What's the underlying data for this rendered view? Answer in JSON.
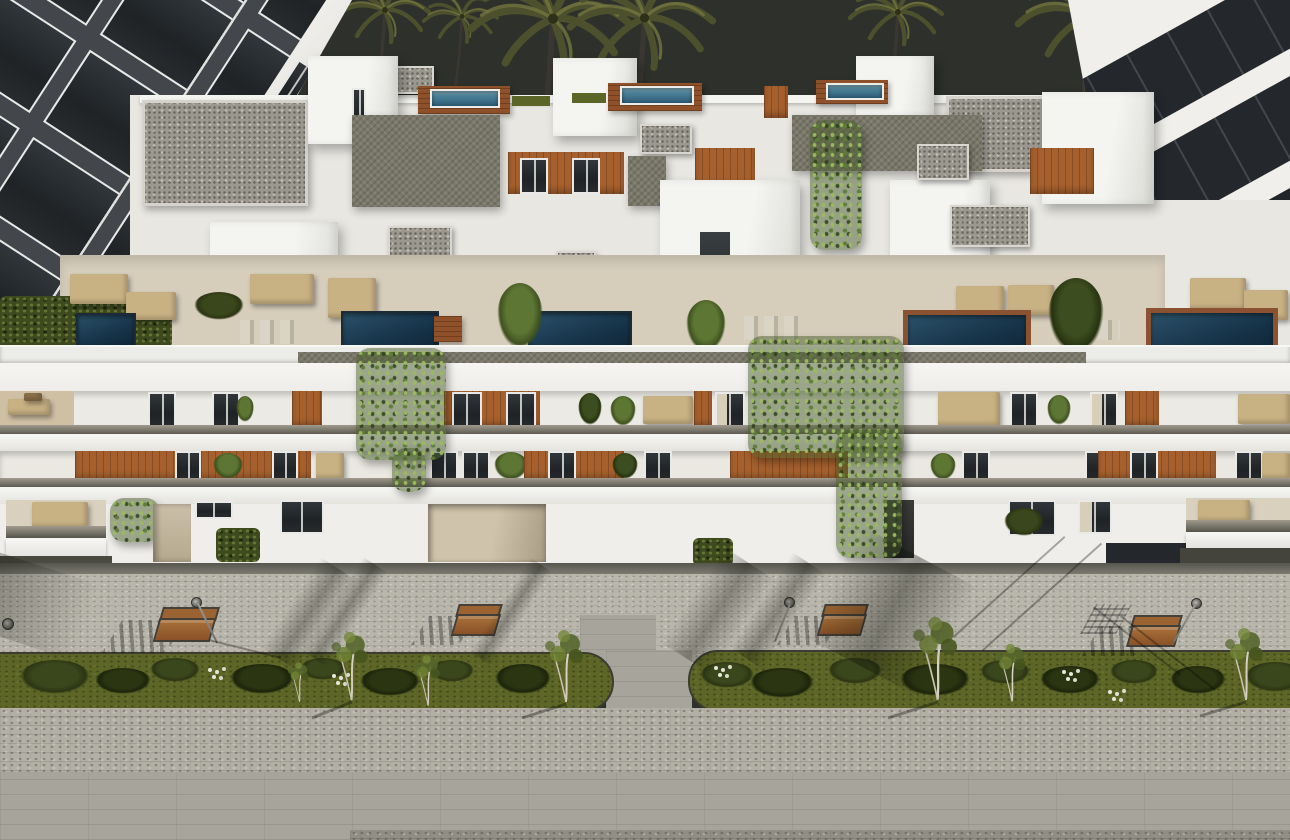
{
  "scene": {
    "title": "Aerial dusk rendering of a modern apartment complex",
    "description": "Photorealistic 3D architectural visualization seen from above at dusk: a long white three-storey apartment building with recessed balconies, timber panels and cascading vines; a rooftop level of private terraces with plunge pools, wooden decks, gravel roofs and outdoor lounge furniture; a dark apartment block on the left and a white building with tinted glass balconies on the right; palm trees against a dark sky; a landscaped boulevard in the foreground with paved sidewalk, two oval planting islands with bushes and young trees, timber benches and street lamps.",
    "setting": "dusk",
    "style": "photorealistic CGI render",
    "view": "high-angle aerial"
  },
  "palette": {
    "sky": "#2d302b",
    "wall_white": "#f0efeb",
    "wall_shade": "#e8e7e2",
    "parapet": "#ecece8",
    "beam_white": "#f3f2ef",
    "left_facade": "#43464a",
    "glass_dark": "#24282c",
    "gravel": "#9b988f",
    "taupe_wall": "#7a7869",
    "wood_deck": "#8f5129",
    "wood_panel": "#a5602e",
    "pool_light": "#8fbccb",
    "pool_deep": "#16344a",
    "lawn": "#5c6528",
    "hedge": "#3e491d",
    "vine": "#5d7634",
    "terrace_floor": "#d6cdbb",
    "furniture": "#c8b183",
    "window_glass": "#24282b",
    "window_frame": "#e9eae7",
    "curtain": "#d8cfba",
    "slab_dark": "#55544b",
    "sidewalk": "#b9b7ac",
    "cobble": "#b2b0a5",
    "pavement": "#a7a59b",
    "pavement_dark": "#918f85",
    "grass_island": "#5d6627",
    "bush": "#36421a",
    "bench_wood": "#9a6331",
    "bench_frame": "#423e38",
    "lamp_metal": "#8f9089",
    "palm_frond": "#4c502c",
    "palm_trunk": "#3a3631",
    "shadow": "rgba(15,15,8,0.3)"
  },
  "background": {
    "left_building": "dark multi-storey apartment block with white window frames",
    "left_building_window_grid": "4 columns x 5 rows",
    "right_building": "white building with tinted glass balcony bands",
    "right_building_glass_bands": 4,
    "palm_trees": 9
  },
  "main_building": {
    "visible_floors": 3,
    "rooftop_plunge_pools": 3,
    "terrace_pools": 5,
    "gravel_roof_patches": 9,
    "vine_cascades": 3,
    "roof_terrace_furniture_sets": 9,
    "balcony_timber_panels": "orange-brown vertical slat panels",
    "sun_loungers_pairs": 3
  },
  "street": {
    "benches": 4,
    "street_lamps": 4,
    "green_islands": 2,
    "island_trees": 7,
    "island_bushes": 18,
    "paving": [
      "smooth curb edge",
      "speckled sidewalk",
      "cobblestone band",
      "smooth slab pavement"
    ]
  }
}
